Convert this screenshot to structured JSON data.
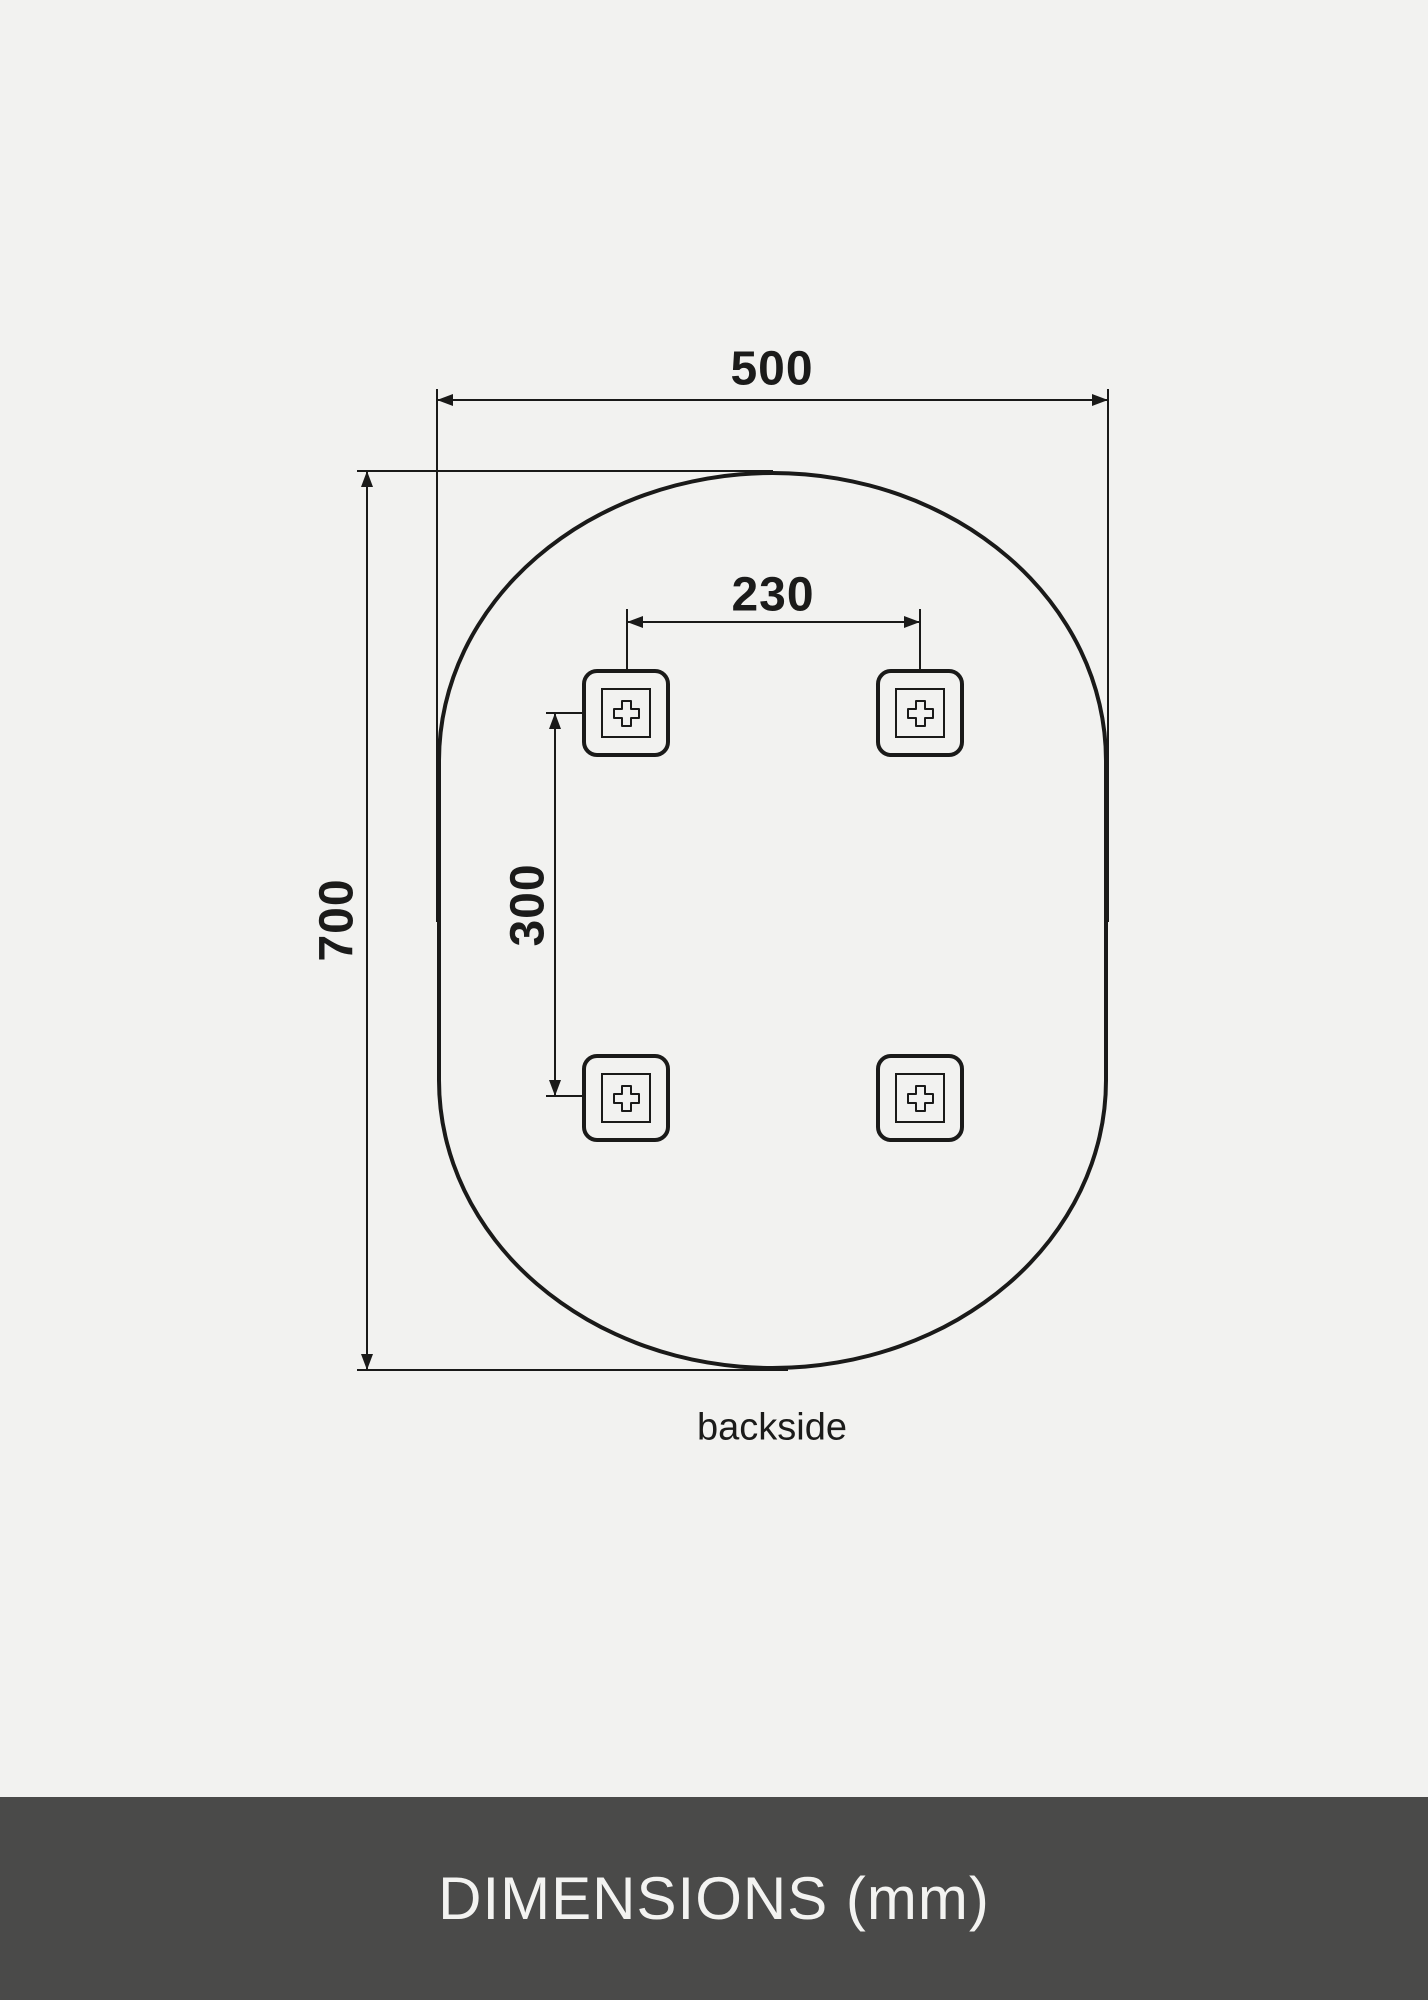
{
  "colors": {
    "background": "#f2f2f0",
    "line": "#1a1a19",
    "text": "#1b1b1a",
    "bar_background": "#4a4a49",
    "bar_text": "#f3f3f1"
  },
  "diagram": {
    "width_mm": "500",
    "height_mm": "700",
    "bracket_spacing_horizontal_mm": "230",
    "bracket_spacing_vertical_mm": "300",
    "view_label": "backside"
  },
  "footer": {
    "title": "DIMENSIONS (mm)"
  }
}
